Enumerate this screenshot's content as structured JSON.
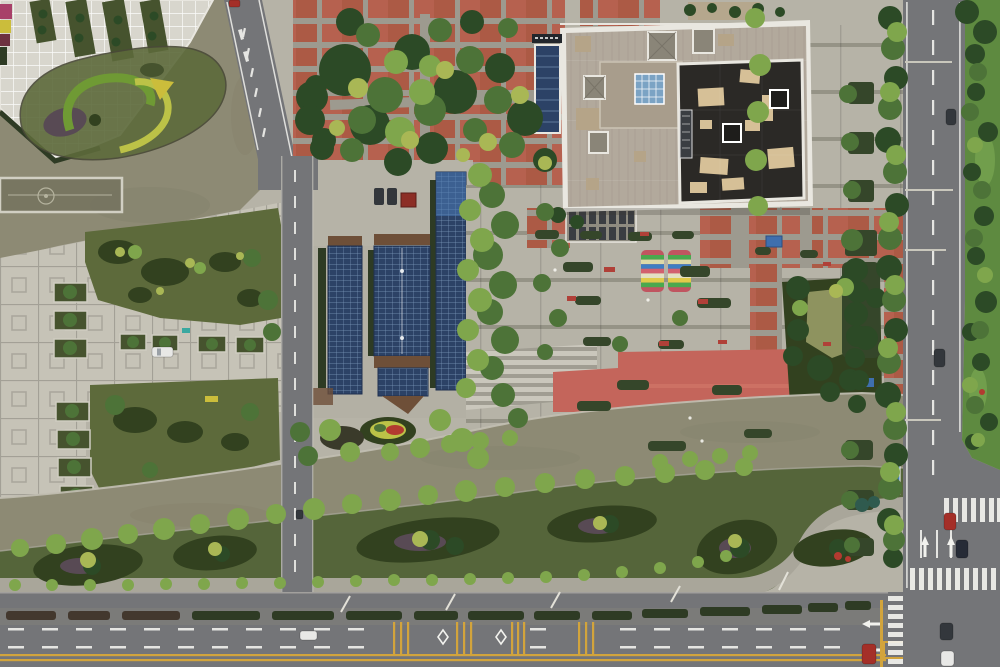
{
  "meta": {
    "scene": "aerial-top-down-view",
    "subject": "civic plaza with rooftop building, solar carports, canals and roads"
  },
  "colors": {
    "base": "#b6b3a7",
    "water": "#8d8a74",
    "waterDark": "#767460",
    "plazaTile": "#c6c3b7",
    "grout": "#a3a096",
    "whiteGridBase": "#d8d6cd",
    "whiteLine": "#ffffff",
    "plazaBand": "#8f8d80",
    "road": "#747578",
    "roadLine": "#f2f2ee",
    "yellowLine": "#d2a43c",
    "brick": "#ac5a45",
    "brickJoint": "#9d9a8f",
    "redPlaza": "#c4655b",
    "redPlazaLight": "#d4796a",
    "sidewalk": "#a9a69a",
    "lawn": "#5d6a3b",
    "bank": "#55653a",
    "lawnDark": "#46532e",
    "bedDark": "#32411f",
    "bedPurple": "#584a54",
    "treeDark": "#2c4a26",
    "treeMid": "#4d7338",
    "treeLight": "#7fa64c",
    "treeYellow": "#a9b755",
    "hedge": "#35462a",
    "hedgeDark": "#2e3b24",
    "hedgeBrown": "#43382e",
    "solar": "#2c4266",
    "solarLine": "#9fc0dd",
    "solarBright": "#4a7ab5",
    "roofWhite": "#e9e7e0",
    "roofMain": "#b2a99c",
    "roofRaised": "#a89d8c",
    "roofTan": "#b5a488",
    "roofDark": "#2b2926",
    "patchTan": "#d6c097",
    "glassBlue": "#7ba3c4",
    "pyramidGray": "#8a8578",
    "ventDark": "#3a3d42",
    "dirt": "#6e4f38",
    "stairLight": "#cac7bc",
    "stairDark": "#a09d92",
    "grassBright": "#5e8a40",
    "pondGreen": "#8e935f",
    "flowerMagenta": "#a84069",
    "flowerYellow": "#cbbd3b",
    "flowerMaroon": "#6d3140",
    "flowerRed": "#b23a30",
    "carWhite": "#e8e8e6",
    "carRed": "#a42f28",
    "carDark": "#33373c",
    "carNavy": "#262b36",
    "shedRed": "#8c2e26",
    "tarpBlue": "#3f6fae",
    "hutBlue": "#3f4f63",
    "benchRed": "#b04038",
    "canalBridgeBlue": "#4178b0",
    "swirlGreen": "#6f9a34",
    "swirlYellow": "#bcc247",
    "poleGray": "#c9c7bc"
  },
  "canopy": {
    "stripes": [
      "#d2606e",
      "#4aa84e",
      "#ddd9a8",
      "#3f7ec2",
      "#d2606e",
      "#e3e0c2",
      "#e0cb4a",
      "#4aa84e",
      "#d2606e"
    ]
  },
  "counts": {
    "rainbow_canopies": 2,
    "solar_carport_arrays": 3,
    "roof_skylights": 6
  }
}
